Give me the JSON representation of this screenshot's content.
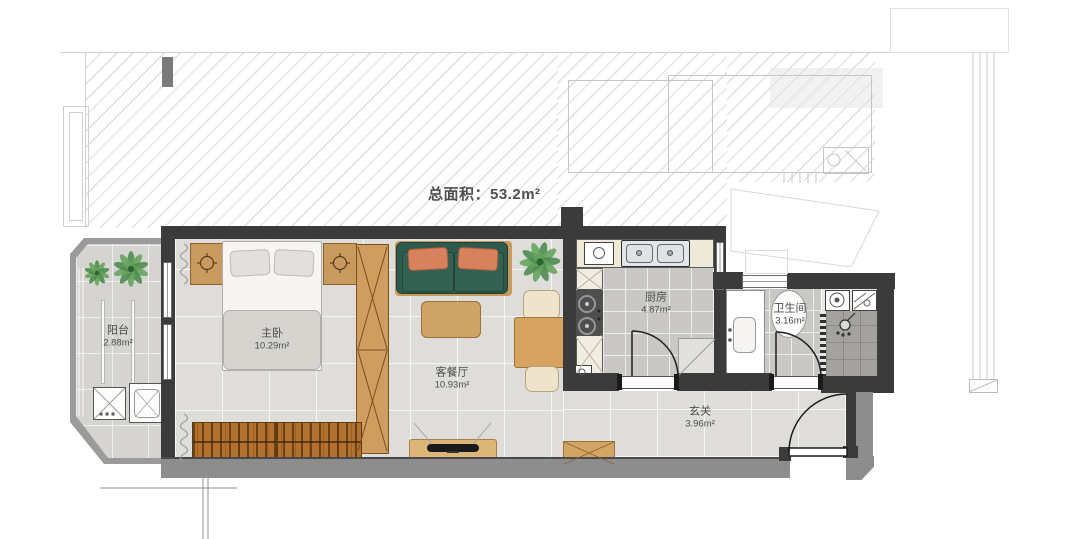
{
  "title": {
    "text": "总面积：53.2m²"
  },
  "rooms": {
    "balcony": {
      "name": "阳台",
      "area": "2.88m²"
    },
    "bedroom": {
      "name": "主卧",
      "area": "10.29m²"
    },
    "living": {
      "name": "客餐厅",
      "area": "10.93m²"
    },
    "kitchen": {
      "name": "厨房",
      "area": "4.87m²"
    },
    "bathroom": {
      "name": "卫生间",
      "area": "3.16m²"
    },
    "entry": {
      "name": "玄关",
      "area": "3.96m²"
    }
  },
  "palette": {
    "interior_wall": "#3b3b3b",
    "exterior_wall": "#8d8d8d",
    "wood_furniture": "#c99a5e",
    "bookshelf_wood": "#b3712f",
    "sofa_green": "#2e5a4d",
    "pillow_orange": "#d8815d",
    "plant_green": "#4d8c50",
    "main_floor": "#dfddda",
    "kitchen_floor": "#cac8c5",
    "shower_floor": "#a4a29f"
  }
}
